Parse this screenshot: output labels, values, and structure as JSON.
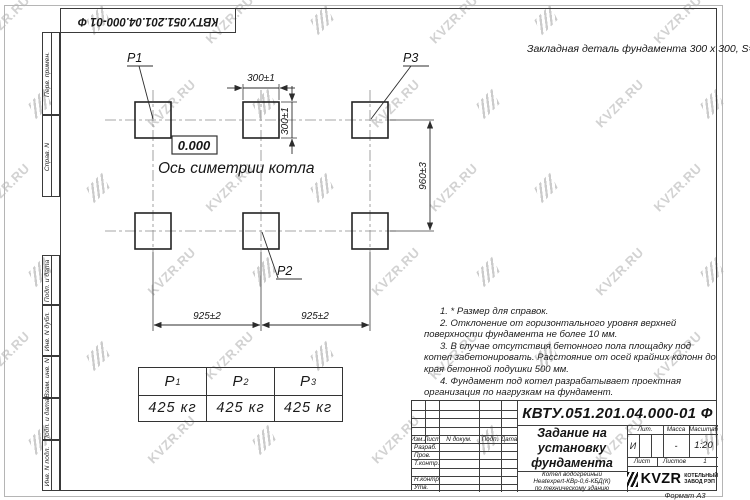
{
  "sheet": {
    "doc_number": "КВТУ.051.201.04.000-01 Ф",
    "format_label": "Формат А3",
    "watermark_text": "KVZR.RU"
  },
  "margin_stamps": {
    "items": [
      "Перв. примен.",
      "Справ. N",
      "Подп. и дата",
      "Инв. N дубл.",
      "Взам. инв. N",
      "Подп. и дата",
      "Инв. N подл."
    ]
  },
  "annotations": {
    "embed_note": "Закладная деталь фундамента  300 х 300,  S=8;",
    "elevation": "0.000",
    "axis_label": "Ось симетрии котла"
  },
  "drawing": {
    "pad_labels": {
      "p1": "Р1",
      "p2": "Р2",
      "p3": "Р3"
    },
    "dimensions": {
      "pad_width": "300±1",
      "pad_height": "300±1",
      "row_spacing": "960±3",
      "col_spacing_1": "925±2",
      "col_spacing_2": "925±2"
    }
  },
  "notes": {
    "n1": "1.  * Размер для справок.",
    "n2": "2.  Отклонение от горизонтального уровня верхней поверхности фундамента не более 10 мм.",
    "n3": "3.  В случае отсутствия бетонного пола площадку под котел забетонировать. Расстояние от осей крайних колонн до края бетонной подушки 500 мм.",
    "n4": "4.  Фундамент под котел разрабатывает проектная организация по нагрузкам на фундамент."
  },
  "load_table": {
    "col1": {
      "label": "Р",
      "sub": "1",
      "value": "425 кг"
    },
    "col2": {
      "label": "Р",
      "sub": "2",
      "value": "425 кг"
    },
    "col3": {
      "label": "Р",
      "sub": "3",
      "value": "425 кг"
    }
  },
  "title_block": {
    "doc_number": "КВТУ.051.201.04.000-01 Ф",
    "title": "Задание на установку фундамента",
    "product_line1": "Котел водогрейный",
    "product_line2": "Heatexpert-КВр-0,6-КБД(К)",
    "product_line3": "по техническому зданию",
    "col_headers": {
      "izm": "Изм.Лист",
      "ndoc": "N докум.",
      "podp": "Подп.",
      "data": "Дата"
    },
    "row_labels": {
      "razrab": "Разраб.",
      "prov": "Пров.",
      "tkontr": "Т.контр.",
      "nkontr": "Н.контр.",
      "utv": "Утв."
    },
    "lit_header": "Лит.",
    "mass_header": "Масса",
    "scale_header": "Масштаб",
    "lit_value": "И",
    "mass_value": "-",
    "scale_value": "1:20",
    "sheet_label": "Лист",
    "sheets_label": "Листов",
    "sheets_value": "1",
    "logo_text": "KVZR",
    "logo_caption_line1": "КОТЕЛЬНЫЙ",
    "logo_caption_line2": "ЗАВОД РЭП"
  }
}
